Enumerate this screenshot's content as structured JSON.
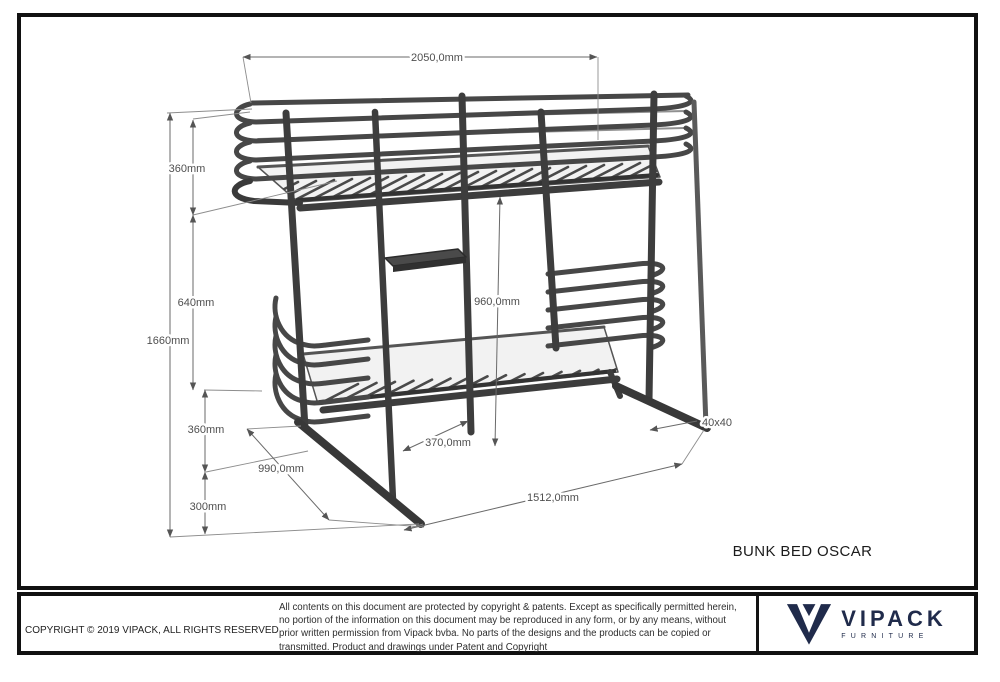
{
  "drawing": {
    "title": "BUNK BED OSCAR",
    "subject": "bunk bed isometric technical drawing",
    "dimensions": {
      "overall_length": "2050,0mm",
      "overall_height": "1660mm",
      "top_rail_height": "360mm",
      "bunk_gap": "640mm",
      "lower_rail_height": "360mm",
      "under_clearance": "300mm",
      "inner_height": "960,0mm",
      "ladder_width": "370,0mm",
      "depth": "990,0mm",
      "runner_span": "1512,0mm",
      "tube_profile": "40x40"
    }
  },
  "footer": {
    "copyright": "COPYRIGHT  © 2019 VIPACK, ALL RIGHTS RESERVED",
    "legal_lines": [
      "All contents on this document are protected by copyright & patents. Except as specifically permitted herein,",
      "no portion of the information on this document may be reproduced in any form, or by any means, without",
      "prior written permission from Vipack bvba. No parts of the designs and the products can be copied or",
      "transmitted. Product and drawings under Patent and Copyright"
    ],
    "brand": {
      "name": "VIPACK",
      "tagline": "FURNITURE"
    }
  },
  "colors": {
    "brand_navy": "#202b4b",
    "metal_dark": "#383838",
    "metal_mid": "#474747",
    "dimension_line": "#6a6a6a",
    "dimension_text": "#4f4f4f",
    "border_black": "#111111"
  }
}
